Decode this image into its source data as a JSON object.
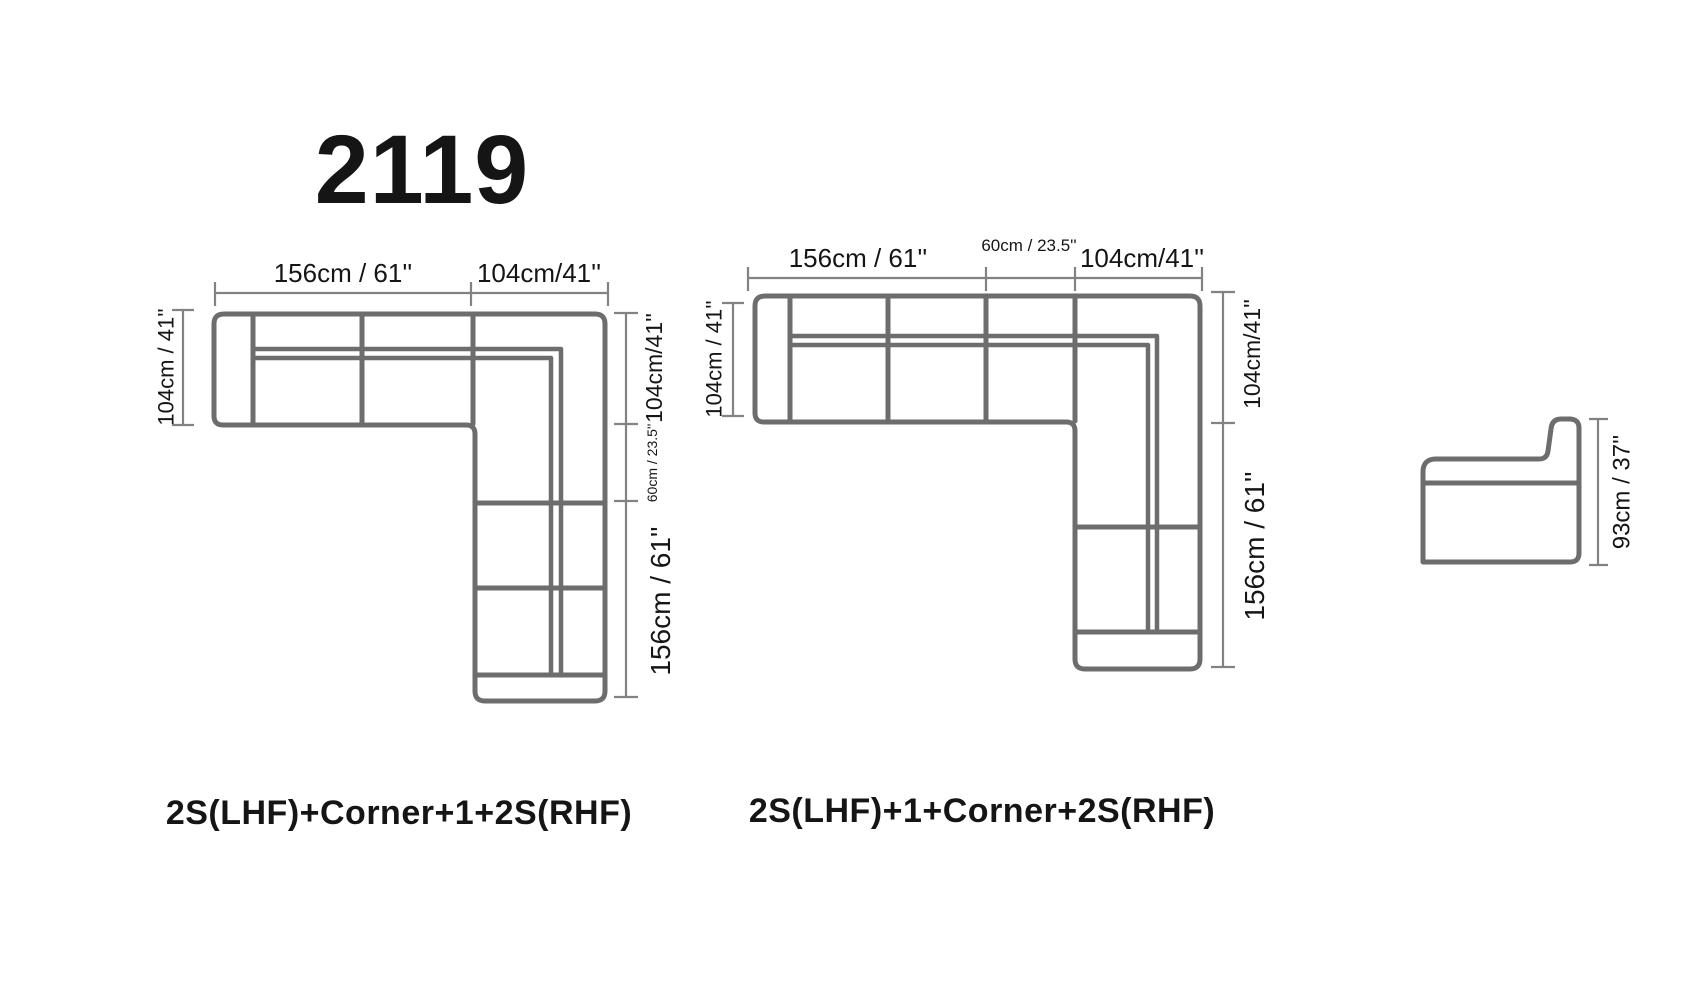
{
  "title": "2119",
  "colors": {
    "sofa_outline": "#6d6d6d",
    "dimension_line": "#828282",
    "text": "#151515",
    "heading_text": "#0a0a0a",
    "background": "#ffffff"
  },
  "diagrams": {
    "left": {
      "caption": "2S(LHF)+Corner+1+2S(RHF)",
      "top_width_main": "156cm / 61''",
      "top_width_corner": "104cm/41''",
      "left_depth": "104cm / 41''",
      "right_corner_depth": "104cm/41''",
      "right_single_seat": "60cm / 23.5''",
      "right_chaise_length": "156cm / 61''"
    },
    "middle": {
      "caption": "2S(LHF)+1+Corner+2S(RHF)",
      "top_width_main": "156cm / 61''",
      "top_single_seat": "60cm / 23.5''",
      "top_width_corner": "104cm/41''",
      "left_depth": "104cm / 41''",
      "right_corner_depth": "104cm/41''",
      "right_chaise_length": "156cm / 61''"
    },
    "side_view": {
      "height": "93cm / 37''"
    }
  }
}
